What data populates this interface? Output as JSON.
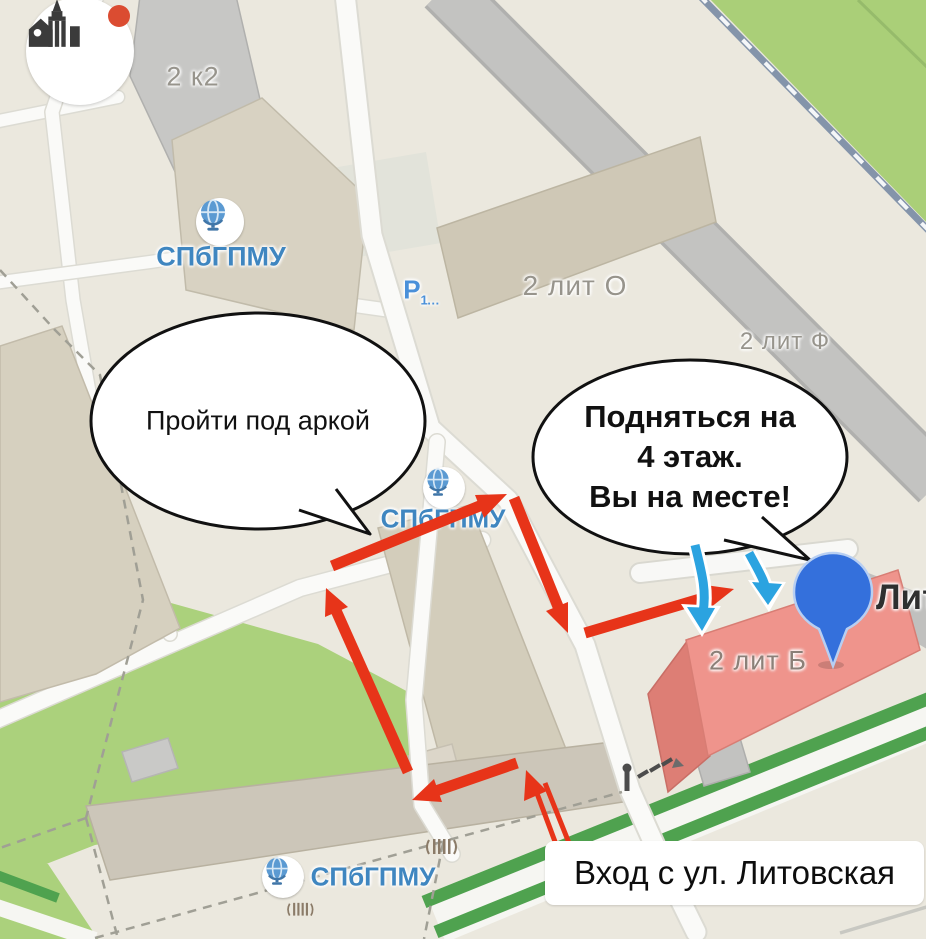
{
  "map": {
    "logo": {
      "icon": "clinic-building-logo",
      "notification_color": "#db4c31"
    },
    "poi": {
      "university_top": "СПбГПМУ",
      "university_mid": "СПбГПМУ",
      "university_bottom": "СПбГПМУ",
      "parking_letter": "P",
      "parking_capacity": "1…"
    },
    "buildings": {
      "b_2k2": "2 к2",
      "b_2lito": "2 лит О",
      "b_2litf": "2 лит Ф",
      "b_2litb": "2 лит Б"
    },
    "street_label": "Литовская",
    "annotations": {
      "bubble_arch": "Пройти под аркой",
      "bubble_floor_lines": [
        "Подняться на",
        "4 этаж.",
        "Вы на месте!"
      ],
      "entrance": "Вход с ул. Литовская"
    },
    "colors": {
      "route_arrow": "#e73419",
      "entry_arrow": "#2ba3e0",
      "pin": "#3470dc",
      "poi_text": "#3f86c0",
      "selected_building": "#ef948c",
      "boulevard_green": "#4fa24f",
      "railway": "#8494aa"
    }
  }
}
